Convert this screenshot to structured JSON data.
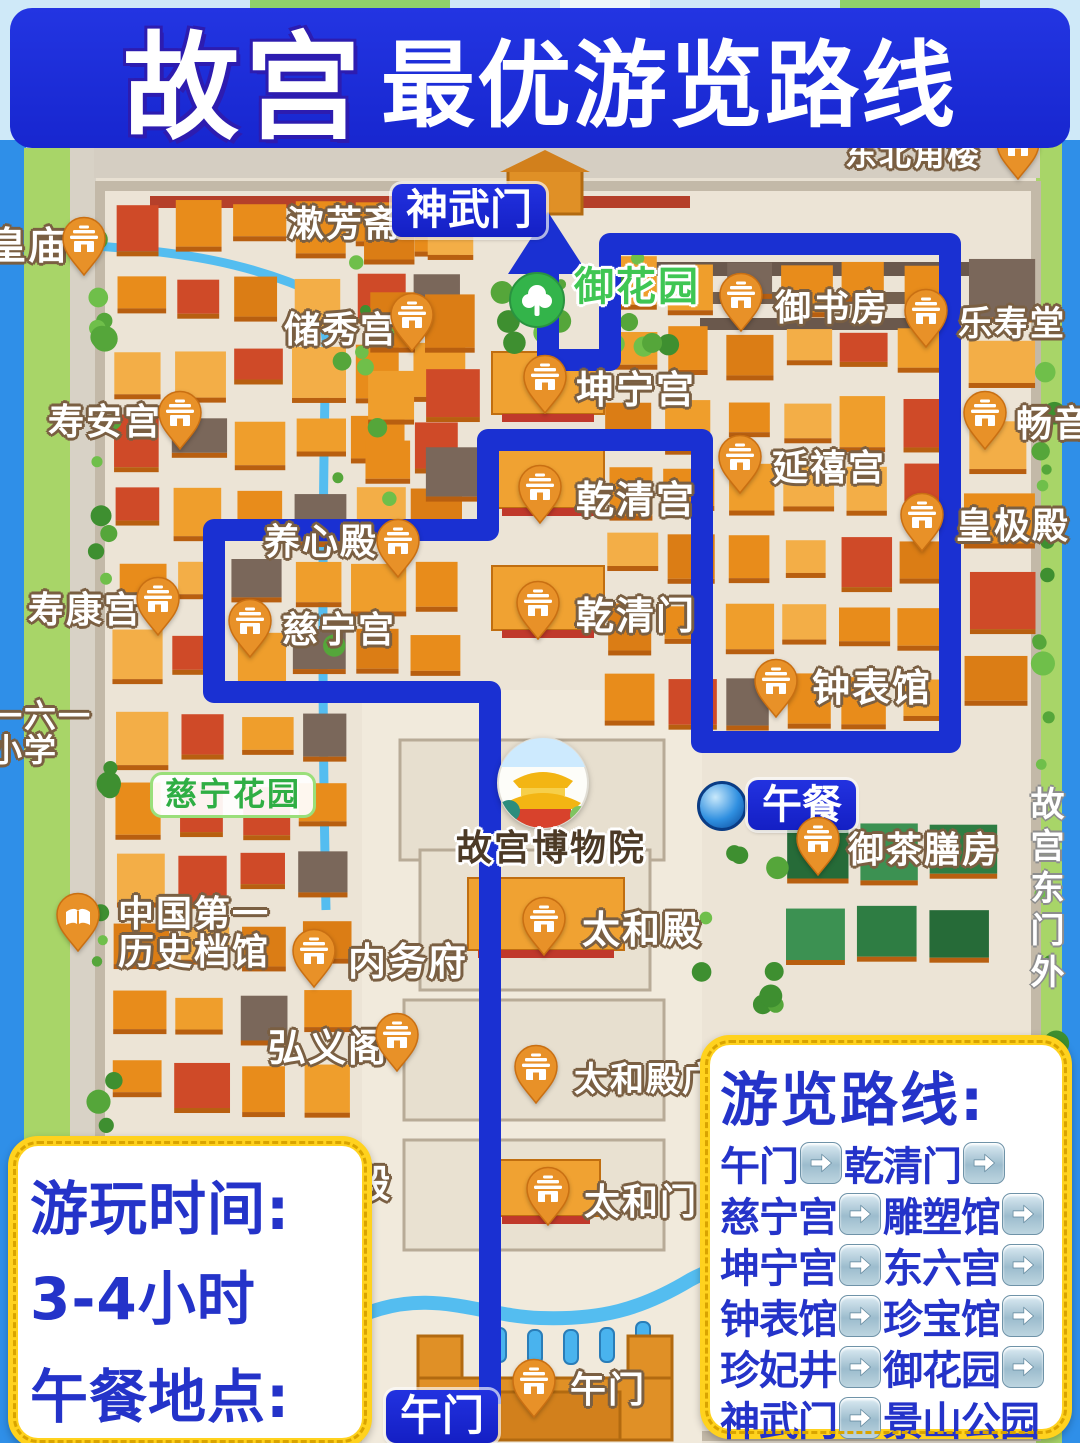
{
  "title": {
    "part1": "故宫",
    "part2": "最优游览路线"
  },
  "colors": {
    "banner_blue": "#1b2ad6",
    "route_blue": "#1a30d2",
    "accent_yellow": "#ffd21e",
    "pin_orange": "#e89128",
    "map_green": "#a8d568",
    "water_blue": "#3f9ff0",
    "text_blue": "#2433c9"
  },
  "map": {
    "labels": [
      {
        "id": "dongbei-jiaolou",
        "text": "东北角楼",
        "style": "white",
        "x": 845,
        "y": 138,
        "size": 32,
        "pin": {
          "x": 1018,
          "y": 152
        }
      },
      {
        "id": "shufangzhai",
        "text": "漱芳斋",
        "style": "white",
        "x": 288,
        "y": 206,
        "size": 36
      },
      {
        "id": "huangmiao",
        "text": "皇庙",
        "style": "white",
        "x": -12,
        "y": 226,
        "size": 38,
        "pin": {
          "x": 84,
          "y": 248
        }
      },
      {
        "id": "yuhuayuan",
        "text": "御花园",
        "style": "green",
        "x": 574,
        "y": 266,
        "size": 40
      },
      {
        "id": "yushufang",
        "text": "御书房",
        "style": "white",
        "x": 775,
        "y": 290,
        "size": 36,
        "pin": {
          "x": 741,
          "y": 304
        }
      },
      {
        "id": "leshoutang",
        "text": "乐寿堂",
        "style": "white",
        "x": 958,
        "y": 306,
        "size": 34,
        "pin": {
          "x": 926,
          "y": 320
        }
      },
      {
        "id": "chuxiugong",
        "text": "储秀宫",
        "style": "white",
        "x": 284,
        "y": 312,
        "size": 36,
        "pin": {
          "x": 412,
          "y": 324
        }
      },
      {
        "id": "kunninggong",
        "text": "坤宁宫",
        "style": "white",
        "x": 576,
        "y": 370,
        "size": 38,
        "pin": {
          "x": 545,
          "y": 386
        }
      },
      {
        "id": "shouangong",
        "text": "寿安宫",
        "style": "white",
        "x": 48,
        "y": 404,
        "size": 36,
        "pin": {
          "x": 180,
          "y": 422
        }
      },
      {
        "id": "changyinge",
        "text": "畅音",
        "style": "white",
        "x": 1016,
        "y": 406,
        "size": 36,
        "pin": {
          "x": 985,
          "y": 422
        }
      },
      {
        "id": "yanxigong",
        "text": "延禧宫",
        "style": "white",
        "x": 772,
        "y": 450,
        "size": 36,
        "pin": {
          "x": 740,
          "y": 466
        }
      },
      {
        "id": "qianqinggong",
        "text": "乾清宫",
        "style": "white",
        "x": 576,
        "y": 480,
        "size": 38,
        "pin": {
          "x": 540,
          "y": 496
        }
      },
      {
        "id": "huangjidian",
        "text": "皇极殿",
        "style": "white",
        "x": 956,
        "y": 508,
        "size": 36,
        "pin": {
          "x": 922,
          "y": 524
        }
      },
      {
        "id": "yangxindian",
        "text": "养心殿",
        "style": "white",
        "x": 264,
        "y": 524,
        "size": 36,
        "pin": {
          "x": 398,
          "y": 550
        }
      },
      {
        "id": "shoukanggong",
        "text": "寿康宫",
        "style": "white",
        "x": 28,
        "y": 592,
        "size": 36,
        "pin": {
          "x": 158,
          "y": 608
        }
      },
      {
        "id": "qianqingmen",
        "text": "乾清门",
        "style": "white",
        "x": 576,
        "y": 596,
        "size": 38,
        "pin": {
          "x": 538,
          "y": 612
        }
      },
      {
        "id": "cininggong",
        "text": "慈宁宫",
        "style": "white",
        "x": 282,
        "y": 612,
        "size": 36,
        "pin": {
          "x": 250,
          "y": 630
        }
      },
      {
        "id": "zhongbiaoguan",
        "text": "钟表馆",
        "style": "white",
        "x": 812,
        "y": 668,
        "size": 38,
        "pin": {
          "x": 776,
          "y": 690
        }
      },
      {
        "id": "school-161",
        "text": "一六一",
        "text2": "小学",
        "style": "white",
        "x": -10,
        "y": 700,
        "size": 32
      },
      {
        "id": "cining-huayuan",
        "text": "慈宁花园",
        "style": "green-box",
        "x": 150,
        "y": 772,
        "size": 32
      },
      {
        "id": "yuchashanfang",
        "text": "御茶膳房",
        "style": "white",
        "x": 848,
        "y": 832,
        "size": 36,
        "pin": {
          "x": 818,
          "y": 848
        }
      },
      {
        "id": "gugong-dongmenwai",
        "text": "故宫东门外",
        "style": "white-vertical",
        "x": 1026,
        "y": 786,
        "size": 34
      },
      {
        "id": "gugong-bowuyuan",
        "text": "故宫博物院",
        "style": "dark",
        "x": 456,
        "y": 830,
        "size": 36
      },
      {
        "id": "zhongguo-diyi-lishi-dangguan",
        "text": "中国第一",
        "text2": "历史档馆",
        "style": "white",
        "x": 118,
        "y": 896,
        "size": 36,
        "pin": {
          "x": 78,
          "y": 924
        },
        "pin_kind": "book"
      },
      {
        "id": "neiwufu",
        "text": "内务府",
        "style": "white",
        "x": 348,
        "y": 942,
        "size": 38,
        "pin": {
          "x": 314,
          "y": 960
        }
      },
      {
        "id": "taihedian",
        "text": "太和殿",
        "style": "white",
        "x": 582,
        "y": 910,
        "size": 38,
        "pin": {
          "x": 544,
          "y": 928
        }
      },
      {
        "id": "hongyige",
        "text": "弘义阁",
        "style": "white",
        "x": 268,
        "y": 1028,
        "size": 38,
        "pin": {
          "x": 397,
          "y": 1044
        }
      },
      {
        "id": "taihedian-guangchang",
        "text": "太和殿广",
        "style": "white",
        "x": 574,
        "y": 1062,
        "size": 34,
        "pin": {
          "x": 536,
          "y": 1076
        }
      },
      {
        "id": "wuyingdian-partial",
        "text": "殿",
        "style": "white",
        "x": 352,
        "y": 1164,
        "size": 38
      },
      {
        "id": "taihemen",
        "text": "太和门",
        "style": "white",
        "x": 584,
        "y": 1184,
        "size": 36,
        "pin": {
          "x": 548,
          "y": 1198
        }
      },
      {
        "id": "wumen",
        "text": "午门",
        "style": "white",
        "x": 570,
        "y": 1372,
        "size": 36,
        "pin": {
          "x": 534,
          "y": 1390
        }
      },
      {
        "id": "shenwumen-badge",
        "text": "神武门",
        "style": "blue-badge",
        "x": 392,
        "y": 184,
        "size": 42
      },
      {
        "id": "wumen-badge",
        "text": "午门",
        "style": "blue-badge",
        "x": 386,
        "y": 1390,
        "size": 42
      },
      {
        "id": "lunch-badge",
        "text": "午餐",
        "style": "blue-badge",
        "x": 748,
        "y": 780,
        "size": 40
      }
    ],
    "museum": {
      "label": "故宫博物院"
    }
  },
  "info_box": {
    "line1": "游玩时间:",
    "line2": "3-4小时",
    "line3": "午餐地点:",
    "line4": "导航“箭亭”"
  },
  "route_box": {
    "title": "游览路线:",
    "rows": [
      {
        "stops": [
          "午门",
          "乾清门"
        ],
        "trail": true
      },
      {
        "stops": [
          "慈宁宫",
          "雕塑馆"
        ],
        "trail": true
      },
      {
        "stops": [
          "坤宁宫",
          "东六宫"
        ],
        "trail": true
      },
      {
        "stops": [
          "钟表馆",
          "珍宝馆"
        ],
        "trail": true
      },
      {
        "stops": [
          "珍妃井",
          "御花园"
        ],
        "trail": true
      },
      {
        "stops": [
          "神武门",
          "景山公园"
        ],
        "trail": false
      }
    ]
  }
}
